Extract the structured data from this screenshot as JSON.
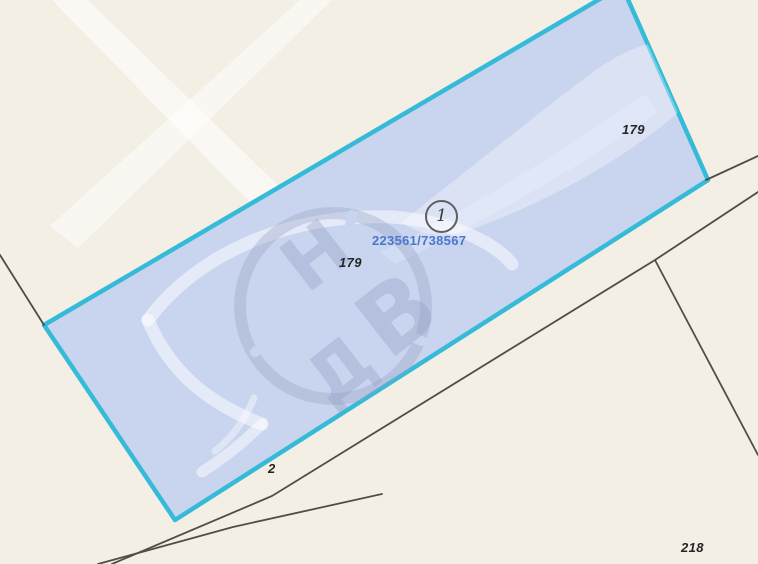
{
  "map": {
    "background_color": "#f3efe4",
    "parcel": {
      "id": "223561/738567",
      "marker": "1",
      "fill_color": "#c9d5ef",
      "border_color": "#35bad8",
      "id_text_color": "#4a77cd"
    },
    "area_labels": {
      "right": "179",
      "center": "179",
      "road": "2",
      "bottom_right": "218"
    },
    "watermark": {
      "letters": [
        "Н",
        "В",
        "Д"
      ]
    },
    "road_line_color": "#4f4d48",
    "label_color": "#242424"
  }
}
